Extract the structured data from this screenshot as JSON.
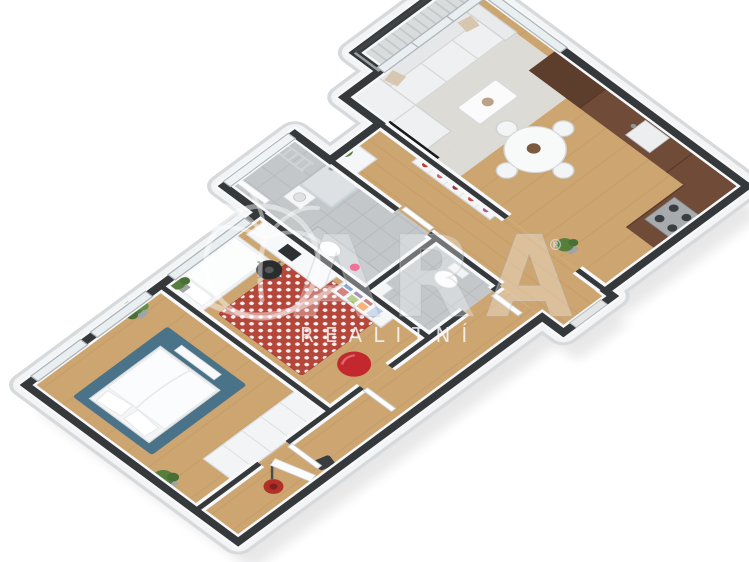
{
  "watermark": {
    "brand": "ARA",
    "registered": "®",
    "subtitle": "REALITNÍ",
    "logo": "palm-tree-icon"
  },
  "colors": {
    "wood": "#CDA571",
    "wood_line": "#BC935E",
    "wall_dark": "#35393C",
    "wall_white": "#F7F8F9",
    "plinth": "#F3F4F6",
    "plinth_edge": "#D7DADC",
    "tile": "#C3C7CA",
    "tile_line": "#A9ADB0",
    "kitchen_dark": "#5D3D2C",
    "kitchen": "#6F4B38",
    "rug_teal": "#4A7389",
    "rug_red": "#B5463A",
    "accent_red": "#C2282E",
    "sofa": "#EFF0F2",
    "rug_gray": "#DCDDDB",
    "plant": "#567F3E",
    "tv": "#17181A",
    "balcony_floor": "#D9DCDD",
    "glass": "#E9EEF1",
    "frame": "#ADB4B9"
  }
}
